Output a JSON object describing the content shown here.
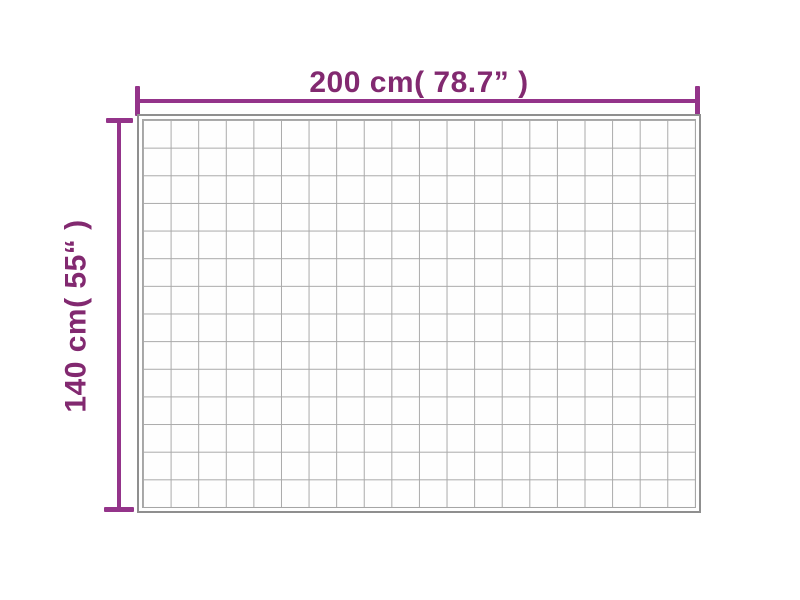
{
  "diagram": {
    "type": "product-dimension-diagram",
    "subject": "quilted-blanket-top-view",
    "width_label": "200 cm( 78.7” )",
    "height_label": "140 cm( 55“ )",
    "grid": {
      "columns": 20,
      "rows": 14
    },
    "colors": {
      "accent": "#94348a",
      "label_text": "#822970",
      "grid_line": "#a9a9a9",
      "blanket_edge": "#8f8f8f",
      "background": "#ffffff"
    }
  }
}
